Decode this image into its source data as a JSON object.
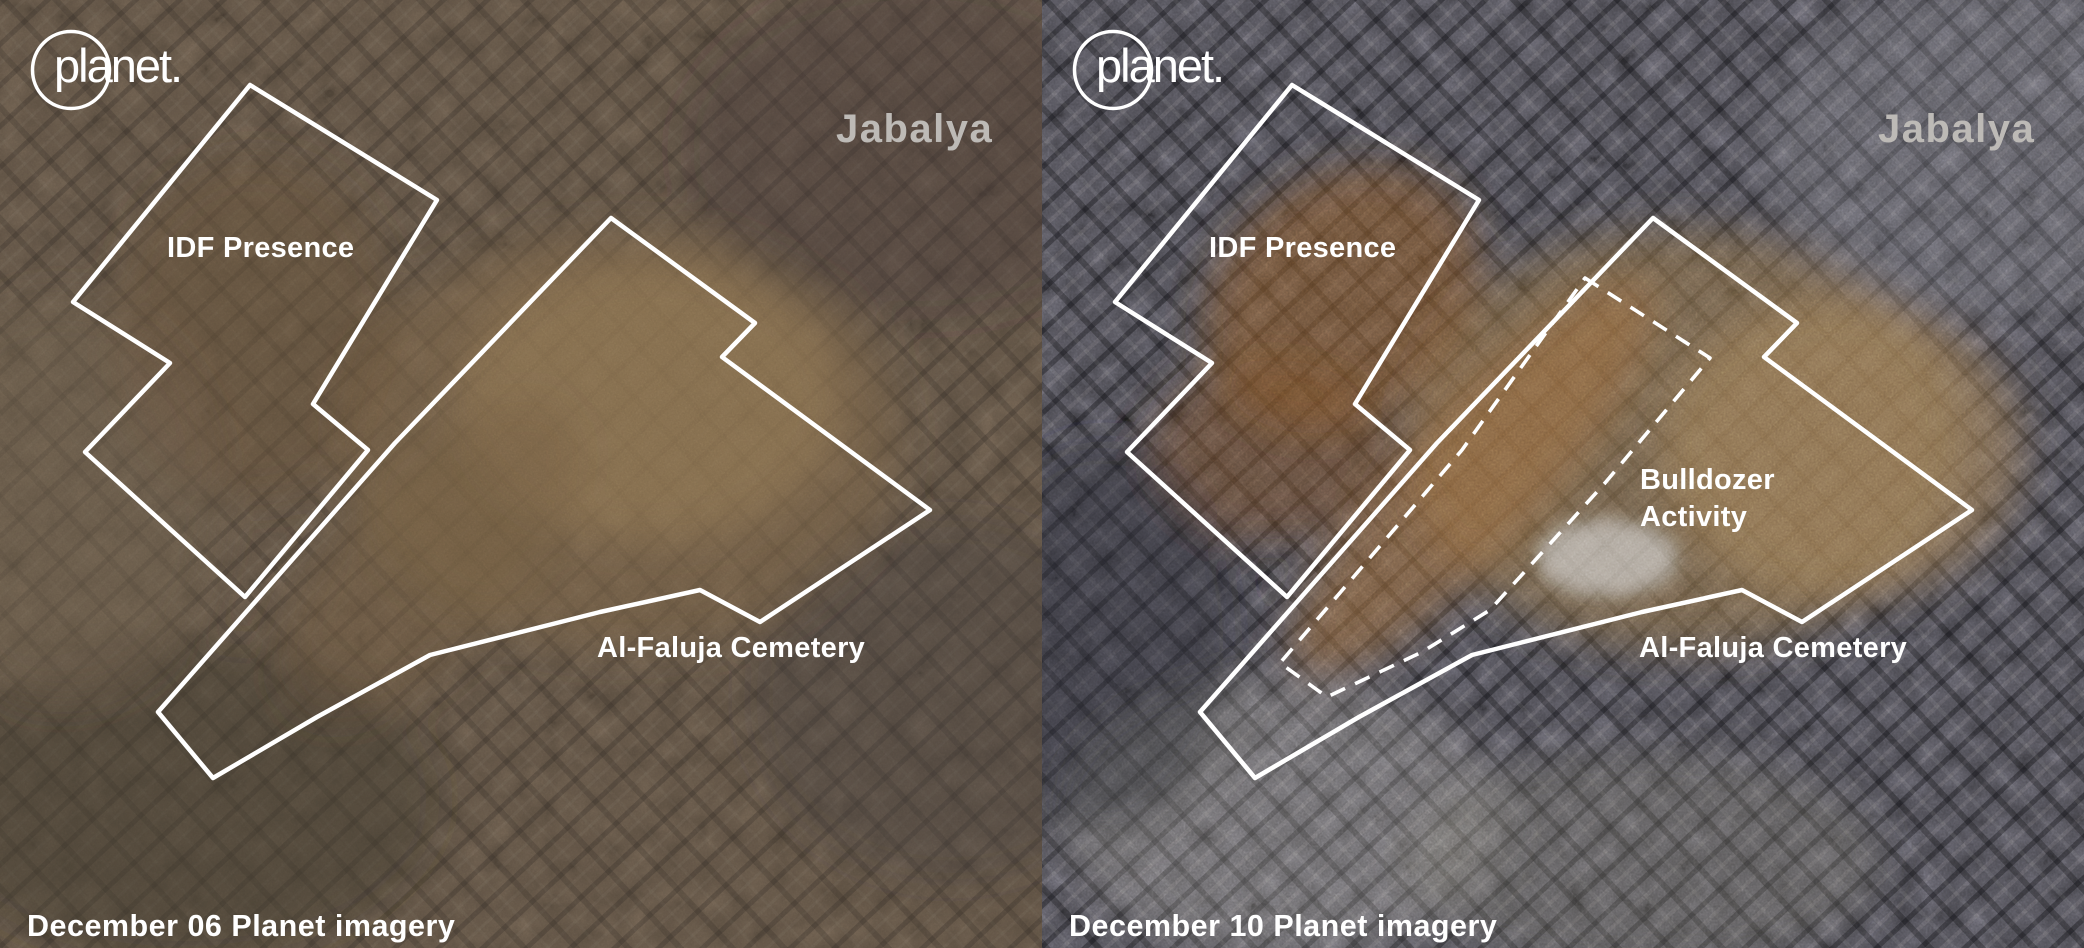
{
  "view": {
    "type": "satellite-before-after-comparison",
    "location": "Jabalya"
  },
  "logo": {
    "wordmark": "planet."
  },
  "panels": {
    "before": {
      "caption": "December 06 Planet imagery",
      "annotations": {
        "idf": "IDF Presence",
        "cemetery": "Al-Faluja Cemetery"
      }
    },
    "after": {
      "caption": "December 10 Planet imagery",
      "annotations": {
        "idf": "IDF Presence",
        "cemetery": "Al-Faluja Cemetery",
        "bulldozer_line1": "Bulldozer",
        "bulldozer_line2": "Activity"
      }
    }
  },
  "colors": {
    "annotation_outline": "#ffffff",
    "location_label": "#bdbab6",
    "before_haze": "#8a6f50",
    "cemetery_dirt": "#9b7a4f",
    "bulldozed_earth": "#9a6c3c"
  }
}
